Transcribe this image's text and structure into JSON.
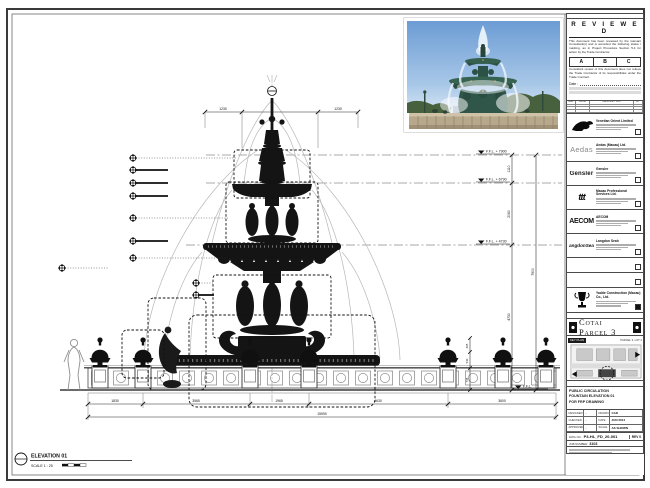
{
  "sheet": {
    "elevation_label": "ELEVATION 01",
    "scale_label": "SCALE 1 : 25"
  },
  "levels": {
    "l1": "F.F.L. + 7900",
    "l2": "F.F.L. + 6790",
    "l3": "F.F.L. + 4730",
    "l4": "F.F.L."
  },
  "dims": {
    "top_left": "1230",
    "top_right": "1230",
    "v1": "1110",
    "v2": "2060",
    "v3": "4730",
    "v_total": "7900",
    "b1": "1830",
    "b2": "3565",
    "b3": "1965",
    "b4": "4630",
    "b5": "3600",
    "b_total": "15590",
    "u1": "465",
    "u2": "530",
    "u3": "735"
  },
  "stamp": {
    "title": "R E V I E W E D",
    "body1": "This document has been reviewed by the relevant Consultant(s) and is accorded the following status / marking, as in Project Procedure Section 5.4 for action by the Trade Contractor.",
    "grade_a": "A",
    "grade_b": "B",
    "grade_c": "C",
    "body2": "Consultant review of this document does not relieve the Trade Contractor of its responsibilities under the Trade Contract.",
    "date_label": "Date :"
  },
  "rev_table": {
    "col_rev": "REV",
    "col_date": "DATE",
    "col_desc": "DESCRIPTION",
    "col_by": "BY"
  },
  "consultants": [
    {
      "name": "Venetian Orient Limited"
    },
    {
      "logo_text": "Aedas",
      "name": "Aedas (Macau) Ltd."
    },
    {
      "logo_text": "Gensler",
      "name": "Gensler"
    },
    {
      "logo_text": "ttt",
      "name": "Macau Professional Services Ltd."
    },
    {
      "logo_text": "AECOM",
      "name": "AECOM"
    },
    {
      "logo_text": "LangdonSeah",
      "name": "Langdon Seah"
    }
  ],
  "contractor": {
    "name": "Yadde Construction (Macau) Co., Ltd."
  },
  "project": {
    "band_label": "PROJECT TITLE",
    "name": "Cotai Parcel 3",
    "key_plan_label": "KEY PLAN",
    "key_plan_note": "PARCEL 3, LOT 2"
  },
  "titleblock": {
    "drawing_title_label": "DRAWING TITLE",
    "title_line1": "PUBLIC CIRCULATION",
    "title_line2": "FOUNTAIN ELEVATION 01",
    "title_line3": "FOR FRP DRAWING",
    "designed_label": "DESIGNED",
    "designed_value": "-",
    "drawn_label": "DRAWN",
    "drawn_value": "CAD",
    "checked_label": "CHECKED",
    "checked_value": "-",
    "date_label": "DATE",
    "date_value": "JUN 2014",
    "approved_label": "APPROVED",
    "approved_value": "-",
    "scale_label": "SCALE",
    "scale_value": "AS SHOWN",
    "dwg_no_label": "DWG NO.",
    "dwg_no_value": "P3-HL_FD_20-001",
    "rev_label": "REV 0",
    "job_label": "JOB NUMBER",
    "job_value": "3103"
  }
}
